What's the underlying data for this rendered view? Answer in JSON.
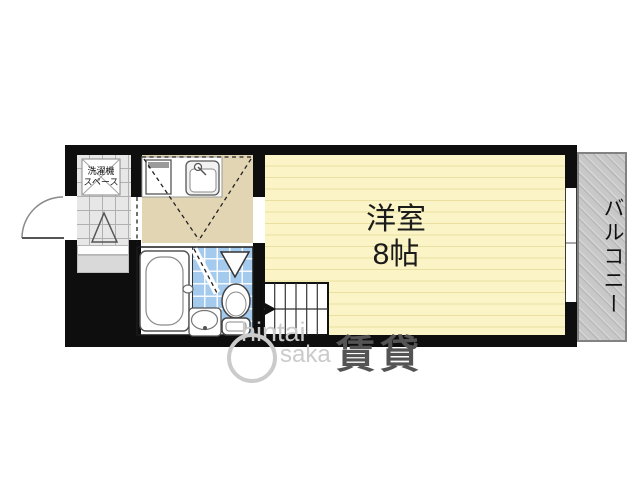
{
  "floorplan": {
    "rooms": {
      "main_room": {
        "label": "洋室",
        "size": "8帖"
      },
      "balcony": {
        "label": "バルコニー"
      },
      "laundry_space": {
        "line1": "洗濯機",
        "line2": "スペース"
      }
    },
    "fixtures": [
      "entry-door",
      "washing-machine-space",
      "genkan-step",
      "kitchen-counter",
      "stove",
      "kitchen-sink",
      "bathtub",
      "wash-basin",
      "toilet",
      "shower-vent",
      "stairs",
      "sliding-window",
      "balcony"
    ],
    "colors": {
      "wall": "#0e0e0e",
      "main_room_fill": "#faf4c6",
      "main_room_stripe": "#e9dfa0",
      "kitchen_fill": "#e2d5b3",
      "bath_tile": "#a4cbee",
      "genkan_tile": "#e7e7e7",
      "balcony_fill": "#c8c8c8",
      "step_fill": "#d9d9d9"
    }
  },
  "watermark": {
    "brand_top": "hintai",
    "brand_bottom": "saka",
    "kanji": "賃貸"
  }
}
